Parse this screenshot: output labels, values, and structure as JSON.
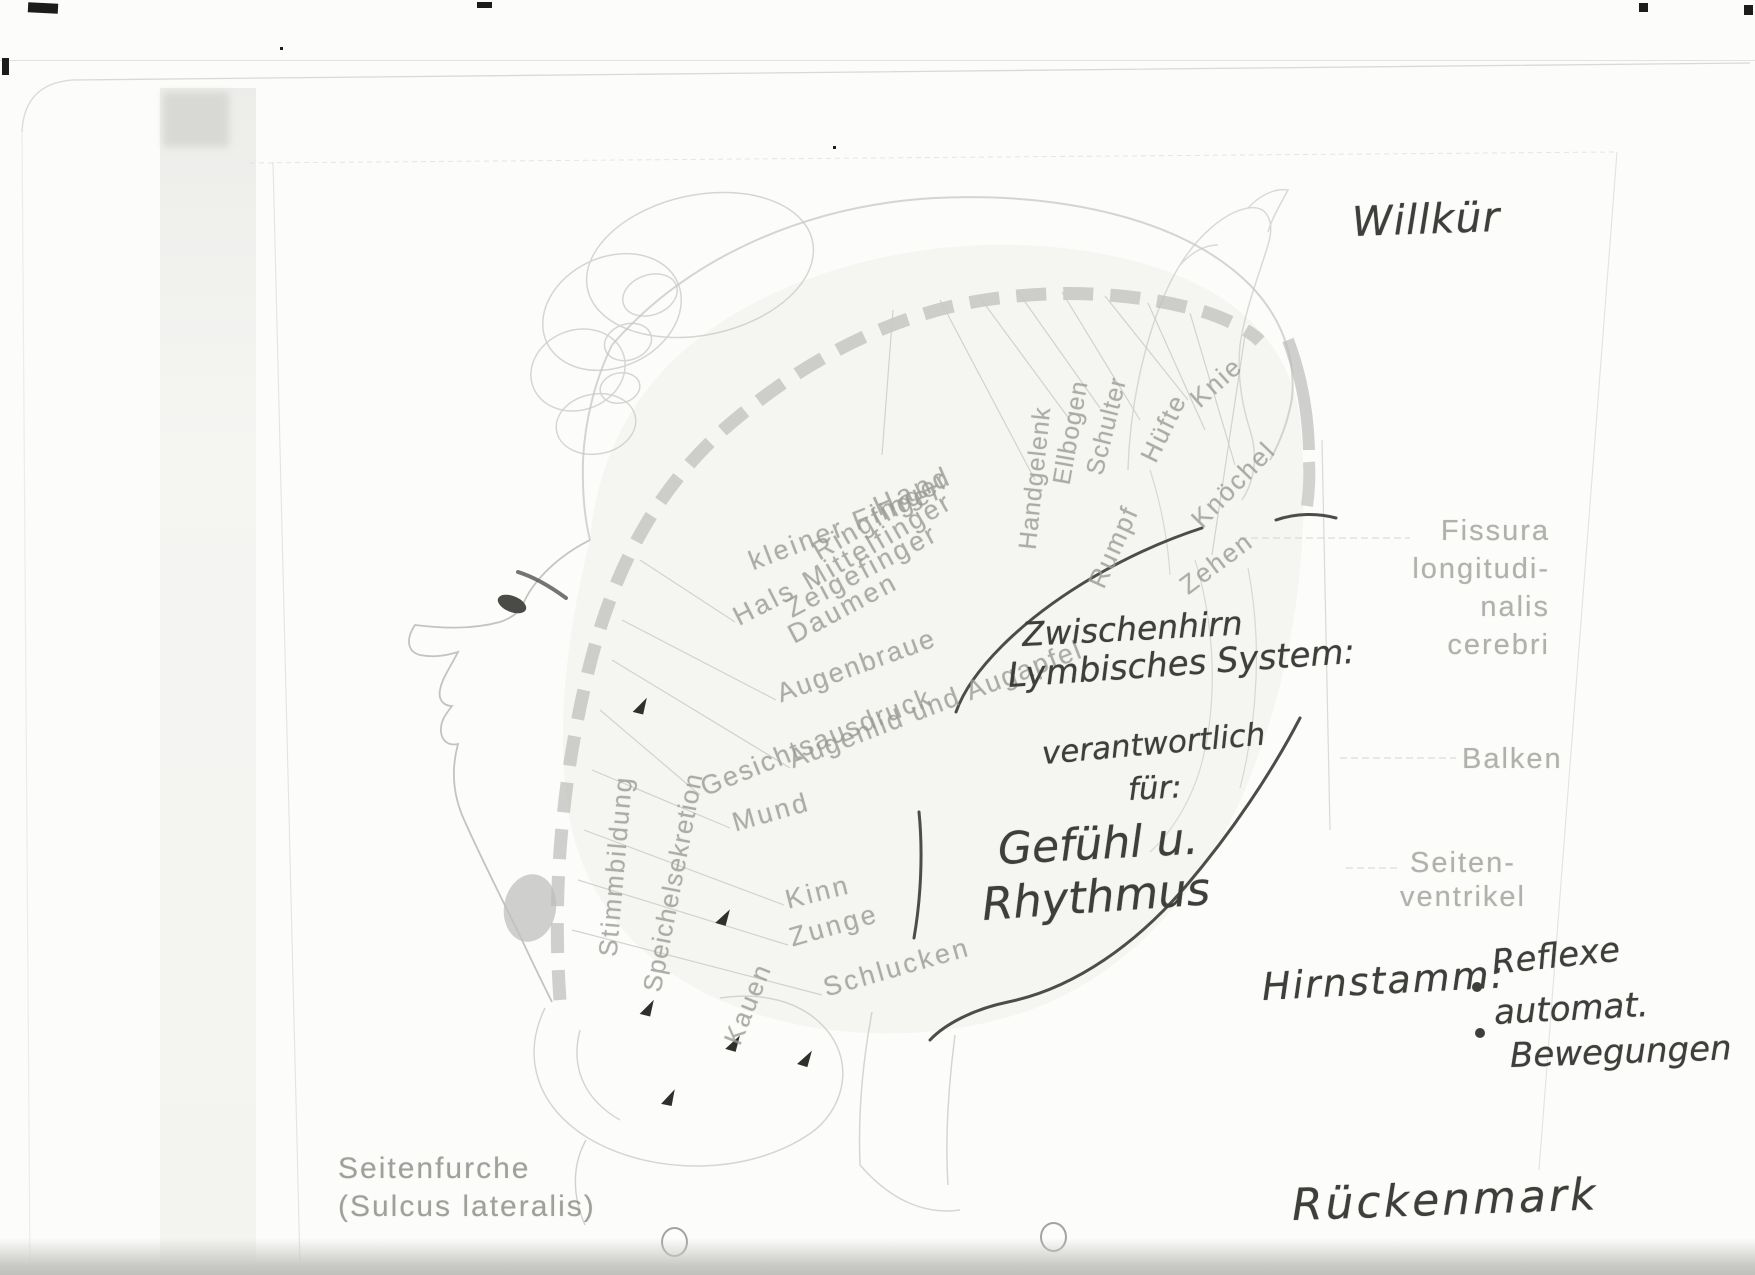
{
  "handwritten": {
    "willkuer": "Willkür",
    "zwischenhirn": "Zwischenhirn",
    "lymbisches_system": "Lymbisches System:",
    "verantwortlich": "verantwortlich",
    "fuer": "für:",
    "gefuehl": "Gefühl u.",
    "rhythmus": "Rhythmus",
    "hirnstamm_label": "Hirnstamm:",
    "hirnstamm_items": [
      "Reflexe",
      "automat.",
      "Bewegungen"
    ],
    "rueckenmark": "Rückenmark",
    "ink_color": "#3e3e3b"
  },
  "printed": {
    "fissura_lines": [
      "Fissura",
      "longitudi-",
      "nalis",
      "cerebri"
    ],
    "balken": "Balken",
    "seitenventrikel_lines": [
      "Seiten-",
      "ventrikel"
    ],
    "seitenfurche_lines": [
      "Seitenfurche",
      "(Sulcus lateralis)"
    ],
    "label_color": "#9b9b95",
    "body_labels": [
      {
        "text": "Hand",
        "x": 875,
        "y": 492,
        "rot": -24,
        "size": 28,
        "ls": 4
      },
      {
        "text": "kleiner Finger",
        "x": 750,
        "y": 547,
        "rot": -21,
        "size": 27,
        "ls": 3
      },
      {
        "text": "Ringfinger",
        "x": 815,
        "y": 538,
        "rot": -30,
        "size": 27,
        "ls": 3
      },
      {
        "text": "Mittelfinger",
        "x": 805,
        "y": 568,
        "rot": -30,
        "size": 27,
        "ls": 3
      },
      {
        "text": "Zeigefinger",
        "x": 788,
        "y": 595,
        "rot": -28,
        "size": 27,
        "ls": 3
      },
      {
        "text": "Daumen",
        "x": 790,
        "y": 621,
        "rot": -28,
        "size": 27,
        "ls": 3
      },
      {
        "text": "Hals",
        "x": 735,
        "y": 603,
        "rot": -27,
        "size": 27,
        "ls": 3
      },
      {
        "text": "Handgelenk",
        "x": 1028,
        "y": 535,
        "rot": -84,
        "size": 25,
        "ls": 1
      },
      {
        "text": "Ellbogen",
        "x": 1062,
        "y": 470,
        "rot": -80,
        "size": 25,
        "ls": 1
      },
      {
        "text": "Schulter",
        "x": 1095,
        "y": 460,
        "rot": -76,
        "size": 25,
        "ls": 1
      },
      {
        "text": "Rumpf",
        "x": 1096,
        "y": 571,
        "rot": -66,
        "size": 26,
        "ls": 2
      },
      {
        "text": "Hüfte",
        "x": 1148,
        "y": 445,
        "rot": -64,
        "size": 26,
        "ls": 2
      },
      {
        "text": "Knie",
        "x": 1194,
        "y": 387,
        "rot": -42,
        "size": 26,
        "ls": 2
      },
      {
        "text": "Knöchel",
        "x": 1196,
        "y": 508,
        "rot": -46,
        "size": 26,
        "ls": 2
      },
      {
        "text": "Zehen",
        "x": 1183,
        "y": 573,
        "rot": -37,
        "size": 26,
        "ls": 2
      },
      {
        "text": "Augenbraue",
        "x": 778,
        "y": 679,
        "rot": -20,
        "size": 27,
        "ls": 2
      },
      {
        "text": "Augenlid und Augapfel",
        "x": 790,
        "y": 745,
        "rot": -21,
        "size": 27,
        "ls": 2
      },
      {
        "text": "Gesichtsausdruck",
        "x": 702,
        "y": 773,
        "rot": -22,
        "size": 27,
        "ls": 2
      },
      {
        "text": "Mund",
        "x": 733,
        "y": 808,
        "rot": -16,
        "size": 27,
        "ls": 3
      },
      {
        "text": "Kinn",
        "x": 786,
        "y": 885,
        "rot": -14,
        "size": 27,
        "ls": 3
      },
      {
        "text": "Zunge",
        "x": 790,
        "y": 923,
        "rot": -16,
        "size": 27,
        "ls": 3
      },
      {
        "text": "Schlucken",
        "x": 824,
        "y": 973,
        "rot": -16,
        "size": 27,
        "ls": 3
      },
      {
        "text": "Stimmbildung",
        "x": 608,
        "y": 941,
        "rot": -85,
        "size": 26,
        "ls": 2
      },
      {
        "text": "Speichelsekretion",
        "x": 652,
        "y": 976,
        "rot": -79,
        "size": 26,
        "ls": 1
      },
      {
        "text": "Kauen",
        "x": 732,
        "y": 1028,
        "rot": -68,
        "size": 26,
        "ls": 2
      }
    ]
  }
}
